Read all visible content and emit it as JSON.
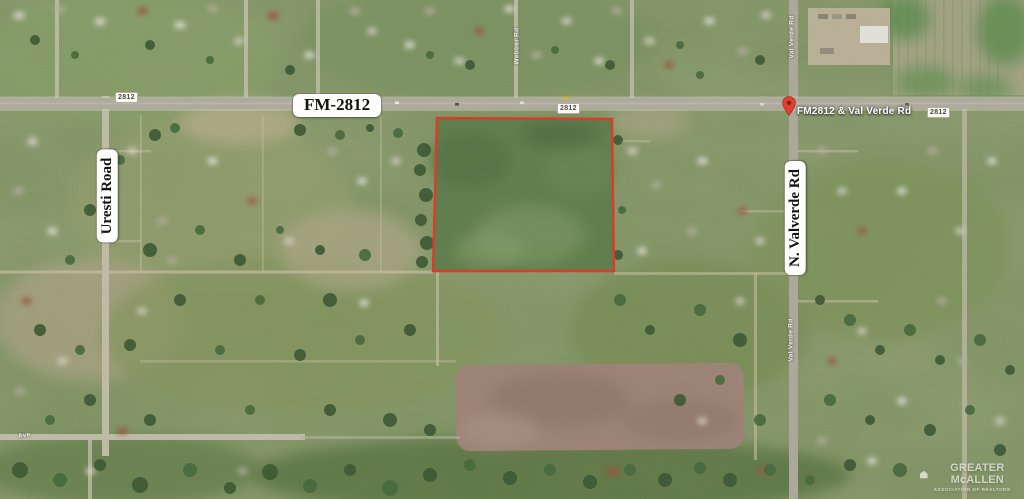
{
  "road_labels": {
    "highway": "FM-2812",
    "shield": "2812",
    "uresti": "Uresti Road",
    "valverde": "N. Valverde Rd"
  },
  "pin": {
    "label": "FM2812 & Val Verde Rd",
    "color": "#e2402f"
  },
  "minor_road_labels": {
    "webber": "Webber Rd",
    "valverde_top": "Val Verde Rd",
    "valverde_mid": "Val Verde Rd",
    "bottom_ave": "Ave"
  },
  "parcel": {
    "points": "437,118 612,119 614,271 433,271",
    "stroke": "#de3a28"
  },
  "watermark": {
    "line1": "GREATER McALLEN",
    "line2": "ASSOCIATION OF REALTORS"
  },
  "colors": {
    "terrain_green": "#7e9160",
    "parcel_green": "#62804e",
    "road_gray": "#b4aea3",
    "minor_road_tan": "#c6bfae",
    "plowed_field": "#a18679",
    "crop_field_tan": "#a6a687",
    "label_bg": "#fdfdfb"
  }
}
